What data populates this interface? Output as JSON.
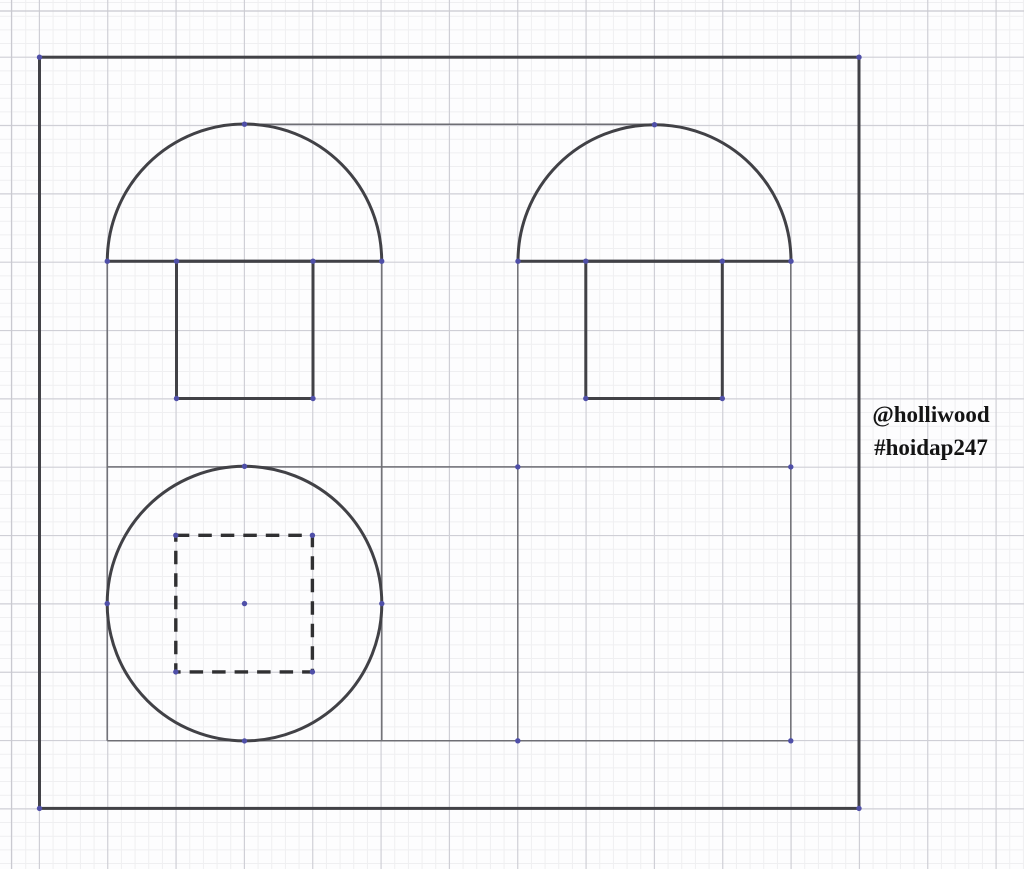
{
  "canvas": {
    "width": 1024,
    "height": 869,
    "background": "#fdfdfe"
  },
  "grid": {
    "minor_spacing": 13.667,
    "major_spacing": 68.333,
    "origin_x": 39.4,
    "origin_y": 57.2,
    "minor_color": "#efeff1",
    "major_color": "#cfcfd6",
    "edge_axis_x": 11.5,
    "edge_axis_y": 11.0,
    "edge_axis_color": "#c9c9d0"
  },
  "styles": {
    "bold_color": "#414146",
    "bold_width": 3,
    "thin_color": "#6e6e74",
    "thin_width": 1.5,
    "dash_color": "#303032",
    "dash_width": 3.4,
    "dash_array": "13.5 9",
    "point_color": "#4f4fa8",
    "point_radius": 2.7
  },
  "figure": {
    "outer_rect": {
      "x": 39.5,
      "y": 57.2,
      "width": 819.5,
      "height": 751.2
    },
    "semicircles": [
      {
        "cx": 244.5,
        "cy": 261.2,
        "r": 137.2
      },
      {
        "cx": 654.5,
        "cy": 261.2,
        "r": 136.5
      }
    ],
    "stems": [
      {
        "x": 176.5,
        "y": 261.2,
        "width": 136.5,
        "height": 137.3
      },
      {
        "x": 585.8,
        "y": 261.2,
        "width": 136.5,
        "height": 137.3
      }
    ],
    "circle": {
      "cx": 244.5,
      "cy": 603.6,
      "r": 137.3
    },
    "dashed_square": {
      "x": 175.8,
      "y": 535.3,
      "width": 136.6,
      "height": 136.6
    },
    "construction_lines": [
      {
        "x1": 107.2,
        "y1": 261.2,
        "x2": 107.2,
        "y2": 740.8
      },
      {
        "x1": 381.8,
        "y1": 261.2,
        "x2": 381.8,
        "y2": 740.8
      },
      {
        "x1": 517.8,
        "y1": 261.2,
        "x2": 517.8,
        "y2": 740.8
      },
      {
        "x1": 790.8,
        "y1": 261.2,
        "x2": 790.8,
        "y2": 740.8
      },
      {
        "x1": 244.5,
        "y1": 124.2,
        "x2": 654.5,
        "y2": 124.2
      },
      {
        "x1": 107.2,
        "y1": 466.9,
        "x2": 790.8,
        "y2": 466.9
      },
      {
        "x1": 107.2,
        "y1": 740.8,
        "x2": 790.8,
        "y2": 740.8
      }
    ],
    "vertex_points": [
      [
        39.5,
        57.2
      ],
      [
        859,
        57.2
      ],
      [
        39.5,
        808.4
      ],
      [
        859,
        808.4
      ],
      [
        244.5,
        124.2
      ],
      [
        654.5,
        124.7
      ],
      [
        107.3,
        261.2
      ],
      [
        381.7,
        261.2
      ],
      [
        518,
        261.2
      ],
      [
        791,
        261.2
      ],
      [
        176.5,
        261.2
      ],
      [
        313,
        261.2
      ],
      [
        176.5,
        398.5
      ],
      [
        313,
        398.5
      ],
      [
        585.8,
        261.2
      ],
      [
        722.3,
        261.2
      ],
      [
        585.8,
        398.5
      ],
      [
        722.3,
        398.5
      ],
      [
        244.5,
        466.3
      ],
      [
        244.5,
        740.9
      ],
      [
        107.2,
        603.6
      ],
      [
        381.8,
        603.6
      ],
      [
        244.5,
        603.6
      ],
      [
        790.8,
        466.9
      ],
      [
        790.8,
        740.8
      ],
      [
        517.8,
        466.9
      ],
      [
        517.8,
        740.8
      ],
      [
        175.8,
        535.3
      ],
      [
        312.4,
        535.3
      ],
      [
        175.8,
        671.9
      ],
      [
        312.4,
        671.9
      ]
    ]
  },
  "watermark": {
    "line1": "@holliwood",
    "line2": "#hoidap247"
  }
}
